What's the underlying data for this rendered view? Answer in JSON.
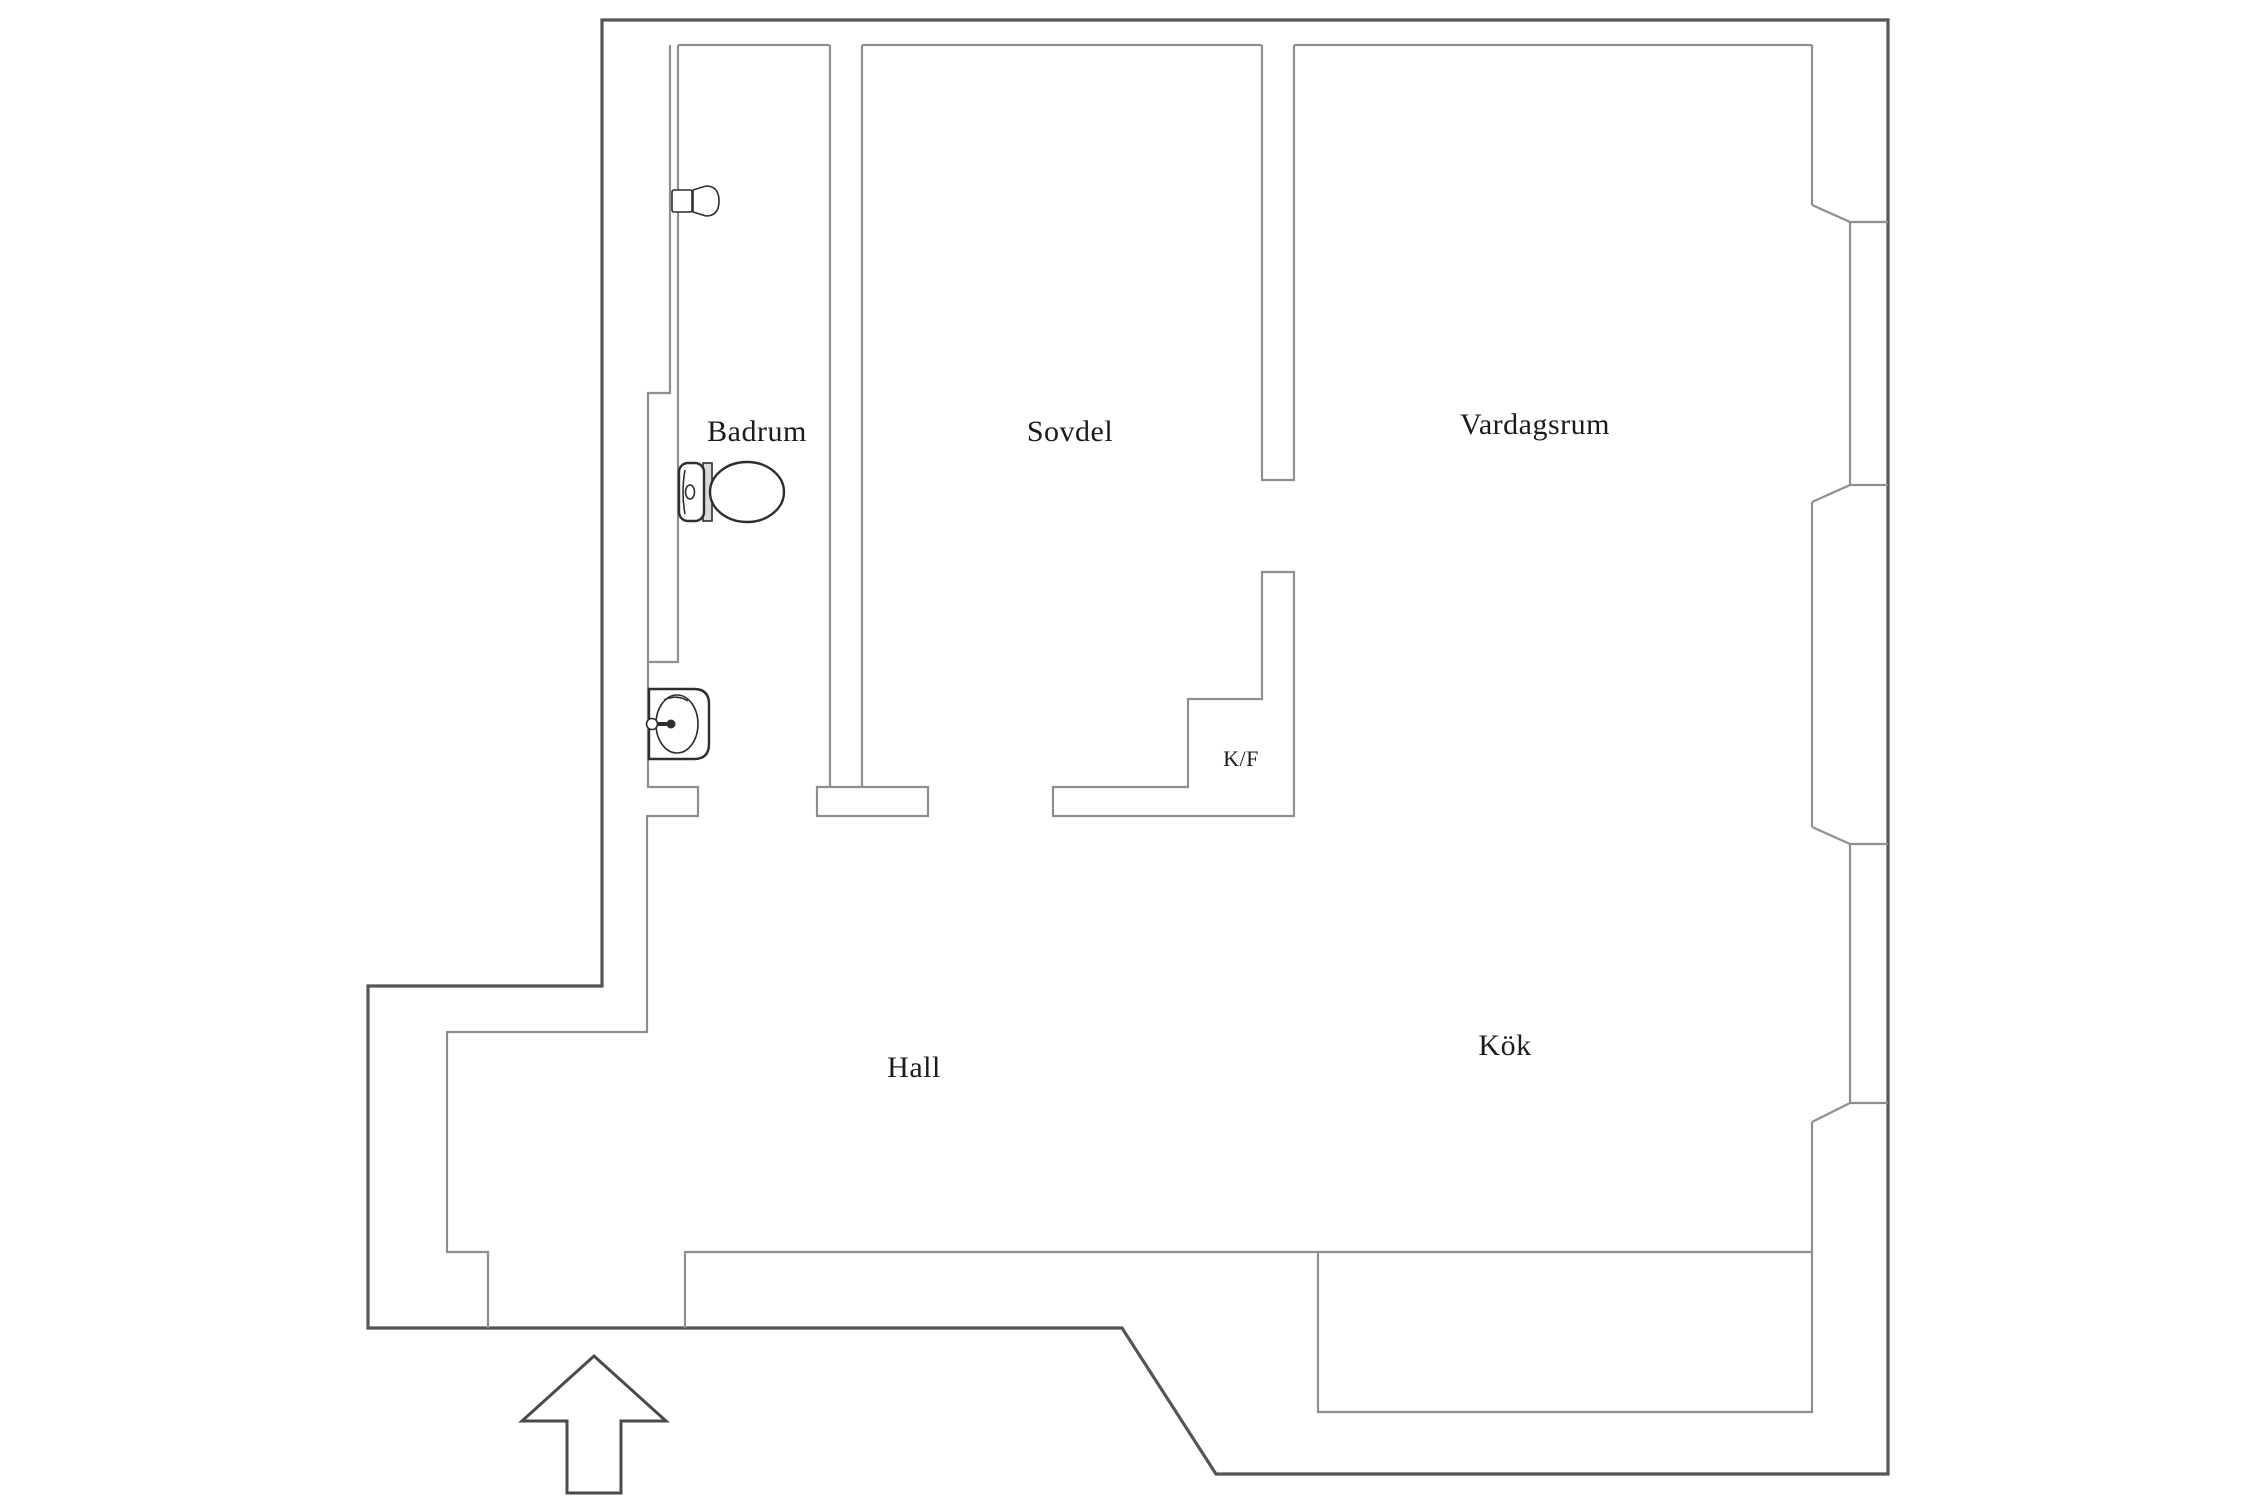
{
  "floor_plan": {
    "type": "apartment-floor-plan",
    "rooms": [
      {
        "id": "badrum",
        "label": "Badrum"
      },
      {
        "id": "sovdel",
        "label": "Sovdel"
      },
      {
        "id": "vardagsrum",
        "label": "Vardagsrum"
      },
      {
        "id": "kf",
        "label": "K/F"
      },
      {
        "id": "hall",
        "label": "Hall"
      },
      {
        "id": "kok",
        "label": "Kök"
      }
    ],
    "fixtures": [
      {
        "name": "toilet",
        "room": "Badrum"
      },
      {
        "name": "sink",
        "room": "Badrum"
      },
      {
        "name": "shower-holder",
        "room": "Badrum"
      },
      {
        "name": "kitchen-counter",
        "room": "Kök"
      }
    ],
    "windows": [
      {
        "name": "window-vardagsrum",
        "side": "right"
      },
      {
        "name": "window-kok",
        "side": "right"
      }
    ],
    "entrance": {
      "symbol": "up-arrow",
      "location": "bottom"
    },
    "colors": {
      "background": "#ffffff",
      "outer_wall": "#555555",
      "interior_lines": "#8f8f8f",
      "fixture_outline": "#2e2e2e",
      "label_text": "#1b1b1b"
    }
  }
}
